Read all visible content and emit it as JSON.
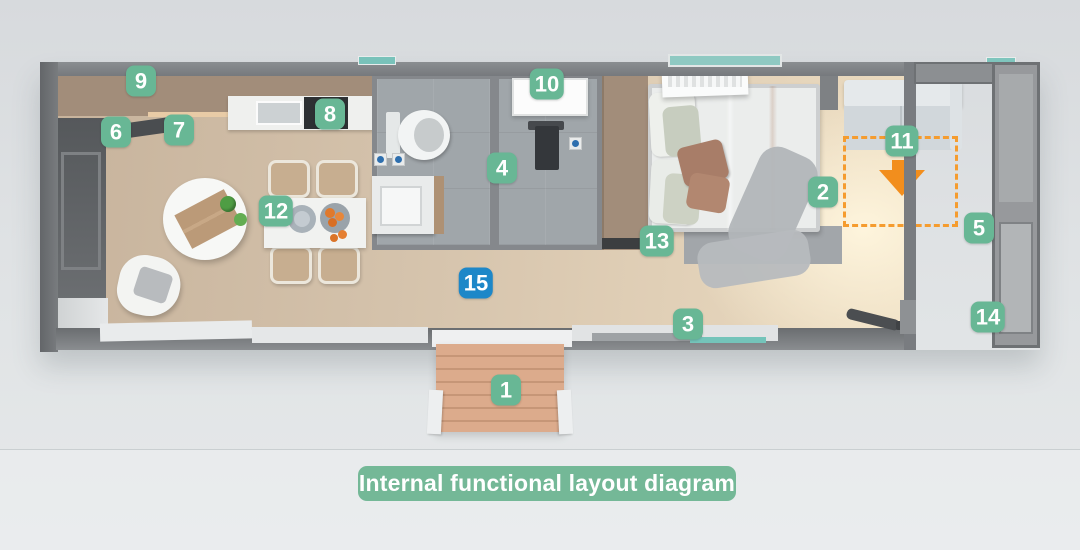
{
  "caption": {
    "label": "Internal functional layout diagram"
  },
  "colors": {
    "marker_green": "#68b795",
    "marker_blue": "#1d87c8",
    "caption_bg": "#74b897",
    "fold_accent_orange": "#f59c2f",
    "arrow_orange": "#f28e1d",
    "wall_gray": "#7b7e82",
    "floor_tan": "#d4c2ab"
  },
  "markers": [
    {
      "label": "1",
      "x": 506,
      "y": 390,
      "variant": "green"
    },
    {
      "label": "2",
      "x": 823,
      "y": 192,
      "variant": "green"
    },
    {
      "label": "3",
      "x": 688,
      "y": 324,
      "variant": "green"
    },
    {
      "label": "4",
      "x": 502,
      "y": 168,
      "variant": "green"
    },
    {
      "label": "5",
      "x": 979,
      "y": 228,
      "variant": "green"
    },
    {
      "label": "6",
      "x": 116,
      "y": 132,
      "variant": "green"
    },
    {
      "label": "7",
      "x": 179,
      "y": 130,
      "variant": "green"
    },
    {
      "label": "8",
      "x": 330,
      "y": 114,
      "variant": "green"
    },
    {
      "label": "9",
      "x": 141,
      "y": 81,
      "variant": "green"
    },
    {
      "label": "10",
      "x": 547,
      "y": 84,
      "variant": "green"
    },
    {
      "label": "11",
      "x": 902,
      "y": 141,
      "variant": "green"
    },
    {
      "label": "12",
      "x": 276,
      "y": 211,
      "variant": "green"
    },
    {
      "label": "13",
      "x": 657,
      "y": 241,
      "variant": "green"
    },
    {
      "label": "14",
      "x": 988,
      "y": 317,
      "variant": "green"
    },
    {
      "label": "15",
      "x": 476,
      "y": 283,
      "variant": "blue"
    }
  ]
}
